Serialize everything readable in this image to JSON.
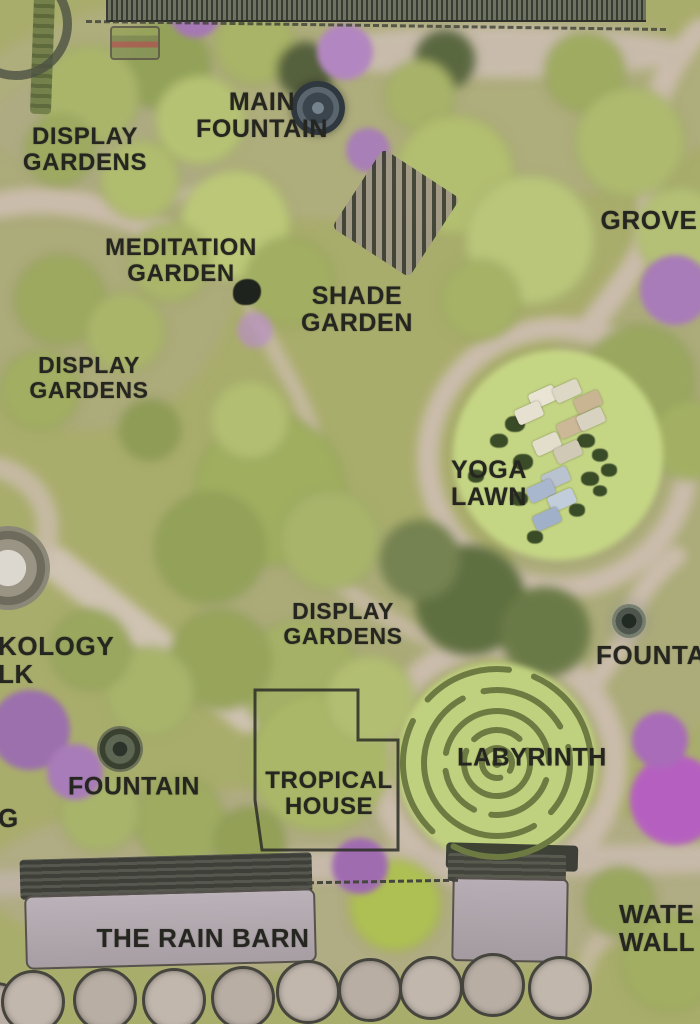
{
  "map": {
    "type": "illustrated-garden-site-plan",
    "palette": {
      "canopy_green": "#aeba6e",
      "bright_lawn": "#c4d584",
      "dark_tree": "#5c6b3d",
      "path_tan": "#cabcab",
      "bloom_purple": "#a87cb8",
      "building_grey": "#b2aab0",
      "label_ink": "#262620"
    },
    "labels": [
      {
        "id": "display-gardens-nw",
        "lines": [
          "DISPLAY",
          "GARDENS"
        ],
        "x": 85,
        "y": 150,
        "size": 24
      },
      {
        "id": "main-fountain",
        "lines": [
          "MAIN",
          "FOUNTAIN"
        ],
        "x": 262,
        "y": 116,
        "size": 25
      },
      {
        "id": "grove",
        "lines": [
          "GROVE"
        ],
        "x": 649,
        "y": 220,
        "size": 26
      },
      {
        "id": "meditation-garden",
        "lines": [
          "MEDITATION",
          "GARDEN"
        ],
        "x": 181,
        "y": 261,
        "size": 24
      },
      {
        "id": "shade-garden",
        "lines": [
          "SHADE",
          "GARDEN"
        ],
        "x": 357,
        "y": 310,
        "size": 25
      },
      {
        "id": "display-gardens-w",
        "lines": [
          "DISPLAY",
          "GARDENS"
        ],
        "x": 89,
        "y": 378,
        "size": 23
      },
      {
        "id": "yoga-lawn",
        "lines": [
          "YOGA",
          "LAWN"
        ],
        "x": 489,
        "y": 484,
        "size": 25
      },
      {
        "id": "display-gardens-c",
        "lines": [
          "DISPLAY",
          "GARDENS"
        ],
        "x": 343,
        "y": 624,
        "size": 23
      },
      {
        "id": "ecology-walk-clipped",
        "lines": [
          "KOLOGY",
          "LK"
        ],
        "x": -2,
        "y": 660,
        "size": 26,
        "anchor": "left"
      },
      {
        "id": "fountain-right-clipped",
        "lines": [
          "FOUNTA"
        ],
        "x": 596,
        "y": 655,
        "size": 26,
        "anchor": "left"
      },
      {
        "id": "edge-g-clipped",
        "lines": [
          "G"
        ],
        "x": -2,
        "y": 818,
        "size": 26,
        "anchor": "left"
      },
      {
        "id": "fountain-left",
        "lines": [
          "FOUNTAIN"
        ],
        "x": 134,
        "y": 787,
        "size": 25
      },
      {
        "id": "tropical-house",
        "lines": [
          "TROPICAL",
          "HOUSE"
        ],
        "x": 329,
        "y": 794,
        "size": 24
      },
      {
        "id": "labyrinth",
        "lines": [
          "LABYRINTH"
        ],
        "x": 532,
        "y": 758,
        "size": 25
      },
      {
        "id": "rain-barn",
        "lines": [
          "THE RAIN BARN"
        ],
        "x": 203,
        "y": 938,
        "size": 26
      },
      {
        "id": "water-wall-clipped",
        "lines": [
          "WATE",
          "WALL"
        ],
        "x": 619,
        "y": 928,
        "size": 26,
        "anchor": "left"
      }
    ],
    "yoga_mats": [
      {
        "x": 543,
        "y": 397,
        "c": "#e9e4d4"
      },
      {
        "x": 567,
        "y": 391,
        "c": "#ddd7c5"
      },
      {
        "x": 588,
        "y": 402,
        "c": "#c9b592"
      },
      {
        "x": 529,
        "y": 413,
        "c": "#e6e0d0"
      },
      {
        "x": 571,
        "y": 427,
        "c": "#ccb897"
      },
      {
        "x": 591,
        "y": 419,
        "c": "#d8d2c0"
      },
      {
        "x": 547,
        "y": 444,
        "c": "#e3ddcc"
      },
      {
        "x": 568,
        "y": 452,
        "c": "#d0c9b6"
      },
      {
        "x": 556,
        "y": 478,
        "c": "#b9c2cf"
      },
      {
        "x": 541,
        "y": 491,
        "c": "#a9b7ce"
      },
      {
        "x": 562,
        "y": 500,
        "c": "#c2cddc"
      },
      {
        "x": 547,
        "y": 519,
        "c": "#9fb0c8"
      }
    ],
    "lawn_figures": [
      {
        "x": 515,
        "y": 424,
        "r": 10
      },
      {
        "x": 499,
        "y": 441,
        "r": 9
      },
      {
        "x": 586,
        "y": 441,
        "r": 9
      },
      {
        "x": 600,
        "y": 455,
        "r": 8
      },
      {
        "x": 523,
        "y": 462,
        "r": 10
      },
      {
        "x": 609,
        "y": 470,
        "r": 8
      },
      {
        "x": 590,
        "y": 479,
        "r": 9
      },
      {
        "x": 519,
        "y": 499,
        "r": 9
      },
      {
        "x": 577,
        "y": 510,
        "r": 8
      },
      {
        "x": 600,
        "y": 491,
        "r": 7
      },
      {
        "x": 476,
        "y": 476,
        "r": 8
      },
      {
        "x": 535,
        "y": 537,
        "r": 8
      }
    ],
    "rain_barrels": {
      "colors": [
        "#b8aea4",
        "#c1b7ad"
      ],
      "items": [
        {
          "x": -4,
          "y": 1012,
          "r": 27
        },
        {
          "x": 33,
          "y": 1002,
          "r": 29
        },
        {
          "x": 105,
          "y": 1000,
          "r": 29
        },
        {
          "x": 174,
          "y": 1000,
          "r": 29
        },
        {
          "x": 243,
          "y": 998,
          "r": 29
        },
        {
          "x": 308,
          "y": 992,
          "r": 29
        },
        {
          "x": 370,
          "y": 990,
          "r": 29
        },
        {
          "x": 431,
          "y": 988,
          "r": 29
        },
        {
          "x": 493,
          "y": 985,
          "r": 29
        },
        {
          "x": 560,
          "y": 988,
          "r": 29
        }
      ]
    }
  }
}
